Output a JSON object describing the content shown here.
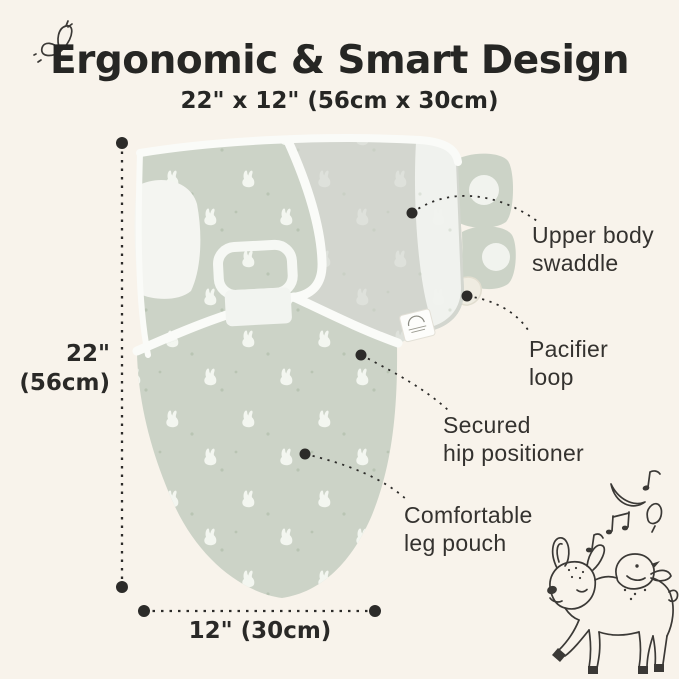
{
  "page": {
    "background_color": "#f8f3eb",
    "ink_color": "#2c2b29"
  },
  "header": {
    "title": "Ergonomic & Smart Design",
    "subtitle": "22\" x 12\" (56cm x 30cm)"
  },
  "dimensions": {
    "height_label": "22\"\n(56cm)",
    "width_label": "12\" (30cm)"
  },
  "callouts": [
    {
      "id": "upper-body-swaddle",
      "label": "Upper body\nswaddle"
    },
    {
      "id": "pacifier-loop",
      "label": "Pacifier\nloop"
    },
    {
      "id": "secured-hip-positioner",
      "label": "Secured\nhip positioner"
    },
    {
      "id": "comfortable-leg-pouch",
      "label": "Comfortable\nleg pouch"
    }
  ],
  "product": {
    "name": "baby swaddle sack",
    "fabric_color": "#ccd3c7",
    "overwrap_color": "#d3d6cf",
    "trim_color": "#fafbf8",
    "pattern": "white bunny silhouettes with small dots"
  },
  "decorations": {
    "top_left_icon": "butterfly-doodle",
    "bottom_right_icon": "fawn-with-bird-and-music-notes"
  }
}
